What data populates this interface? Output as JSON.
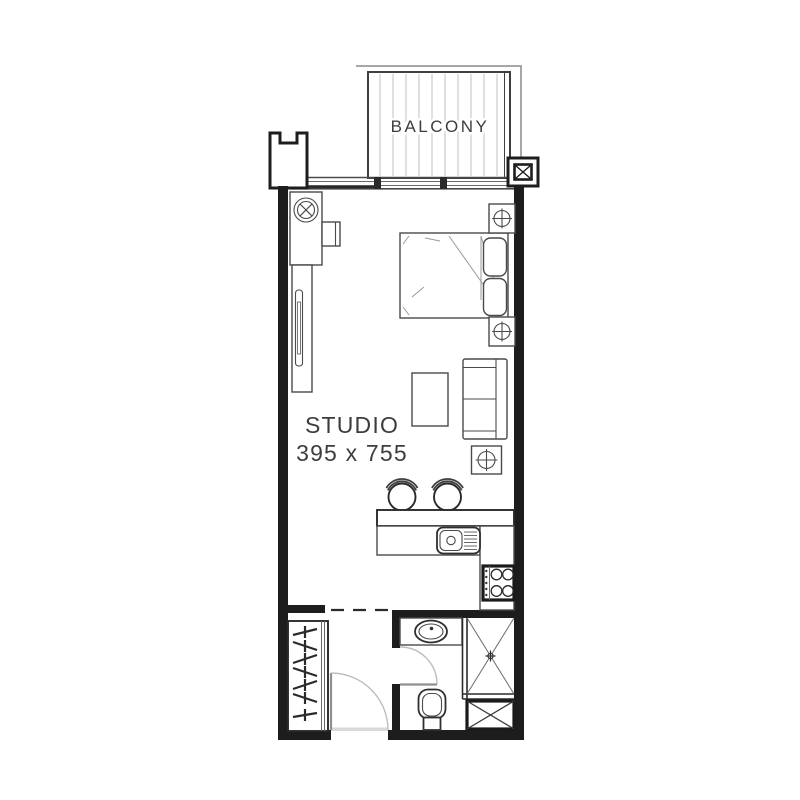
{
  "title": "Studio apartment floor plan",
  "labels": {
    "balcony": "BALCONY",
    "room_name": "STUDIO",
    "room_dims": "395 x 755"
  },
  "colors": {
    "wall": "#1d1d1d",
    "outline": "#3f3f3f",
    "furniture": "#4a4a4a",
    "linen_detail": "#9a9a9a",
    "door_arc": "#bdbdbd",
    "deck_stripe": "#cbcbcb",
    "text": "#3d3d3d",
    "background": "#ffffff"
  },
  "fixtures": [
    "balcony-deck",
    "notched-pillar",
    "shaft-x-box",
    "window-band",
    "wardrobe-unit",
    "ceiling-fixture-x-circle",
    "sliding-panel",
    "double-bed",
    "pillows",
    "nightstand-top",
    "nightstand-bottom",
    "sofa",
    "coffee-table",
    "side-table-cross",
    "bar-stool-left",
    "bar-stool-right",
    "kitchen-bar-counter",
    "kitchen-sink",
    "stove-hob",
    "hanger-closet",
    "entry-door",
    "dashed-partition",
    "bathroom-vanity",
    "oval-basin",
    "bathroom-door",
    "toilet",
    "shower-x",
    "utility-x-box"
  ]
}
